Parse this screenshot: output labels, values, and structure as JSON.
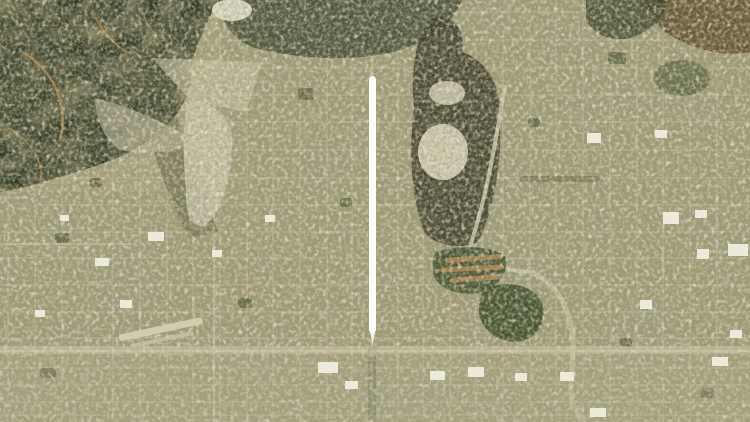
{
  "window": {
    "width_px": 750,
    "height_px": 422
  },
  "scene": {
    "type": "satellite-aerial-photo",
    "description": "Satellite view of a suburban street-grid valley city: dark forested mountains in the upper left, a pale alluvial wash and spreading basin left of center, a dark gravel quarry with a sandy basin right of center, a golf course with dark green fairways mid-right, a winding flood channel on the right, small airstrip lower left, lighter commercial corridor along the bottom",
    "visible_text": "none"
  },
  "annotation": {
    "shape": "vertical-line",
    "color": "#fcfcf9",
    "x_center_px": 372,
    "y_top_px": 76,
    "y_bottom_px": 345,
    "width_px": 7
  },
  "palette": {
    "ground_base": "#a29a74",
    "ground_light": "#cdc6aa",
    "mountain_forest": "#2f351f",
    "forest_band": "#38402a",
    "mountain_ridge_tan": "#b9894a",
    "foothill_shadow": "#55573b",
    "quarry_dark": "#3e3b28",
    "quarry_sand": "#d8d1b5",
    "park_green": "#3c4826",
    "roof_orange": "#c08a50",
    "wash_light": "#cbc3a5",
    "pond_light": "#e4decb",
    "building_white": "#eceadb",
    "road_light": "#cfc8ab",
    "tree_street_dark": "#6e6a4c"
  }
}
